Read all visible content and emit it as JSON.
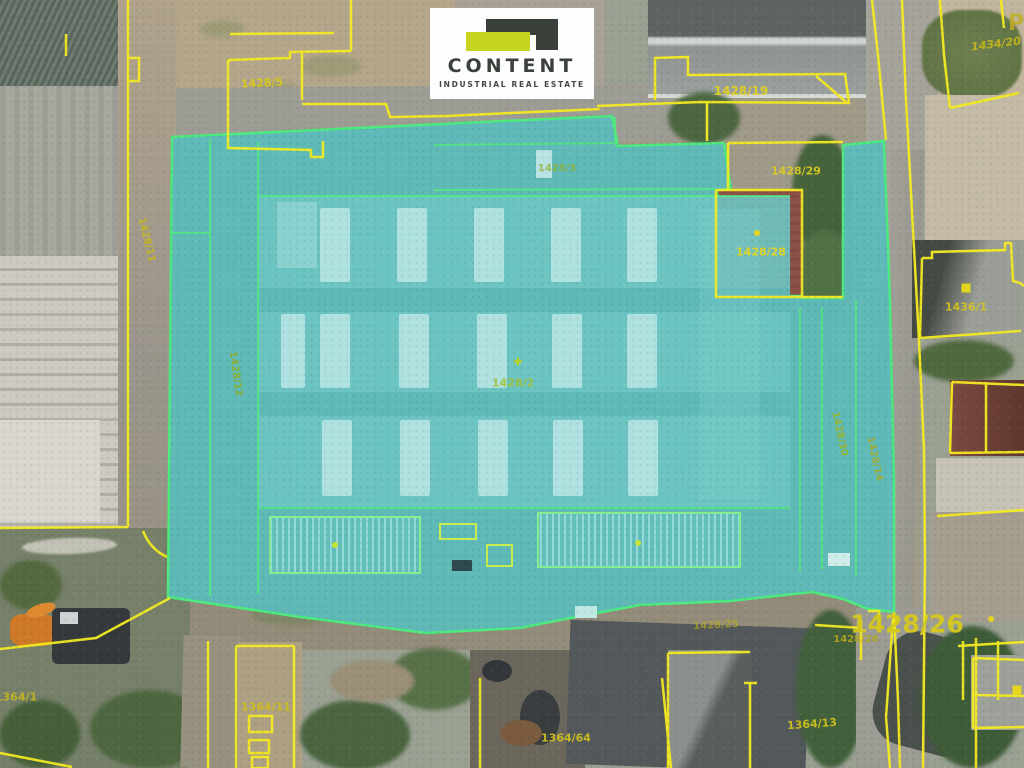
{
  "branding": {
    "logo_name": "CONTENT",
    "logo_tagline": "INDUSTRIAL REAL ESTATE",
    "logo_lime": "#c6d31f",
    "logo_charcoal": "#393f39"
  },
  "map": {
    "highlighted_parcel": "1428/2",
    "highlight_fill": "#5cbcba",
    "highlight_border": "#4dea7e",
    "parcel_line_color": "#f3ea22",
    "parcel_labels": [
      {
        "text": "1428/5",
        "x": 262,
        "y": 83,
        "size": 11,
        "rot": -3,
        "color": "#d8c81f",
        "opacity": 0.95
      },
      {
        "text": "1428/19",
        "x": 741,
        "y": 91,
        "size": 12,
        "rot": 0,
        "color": "#e0d122",
        "opacity": 0.95
      },
      {
        "text": "1428/29",
        "x": 796,
        "y": 171,
        "size": 11,
        "rot": 0,
        "color": "#ddcd20",
        "opacity": 0.9
      },
      {
        "text": "1428/28",
        "x": 761,
        "y": 252,
        "size": 11,
        "rot": 0,
        "color": "#e6d51f",
        "opacity": 0.95
      },
      {
        "text": "1434/20",
        "x": 996,
        "y": 44,
        "size": 11,
        "rot": -7,
        "color": "#c8b81a",
        "opacity": 0.9,
        "italic": true
      },
      {
        "text": "P",
        "x": 1016,
        "y": 24,
        "size": 22,
        "rot": 0,
        "color": "#c0ae23",
        "opacity": 0.85,
        "bold": true
      },
      {
        "text": "1436/1",
        "x": 966,
        "y": 307,
        "size": 11,
        "rot": 0,
        "color": "#d6c51e",
        "opacity": 0.9
      },
      {
        "text": "1428/11",
        "x": 146,
        "y": 240,
        "size": 10,
        "rot": 76,
        "color": "#c7b81c",
        "opacity": 0.9
      },
      {
        "text": "1428/12",
        "x": 235,
        "y": 374,
        "size": 10,
        "rot": 82,
        "color": "#8fae2b",
        "opacity": 0.9
      },
      {
        "text": "1428/3",
        "x": 557,
        "y": 169,
        "size": 10,
        "rot": 0,
        "color": "#93b02c",
        "opacity": 0.75
      },
      {
        "text": "1428/2",
        "x": 513,
        "y": 383,
        "size": 11,
        "rot": 0,
        "color": "#a3c02e",
        "opacity": 0.85
      },
      {
        "text": "1428/30",
        "x": 839,
        "y": 434,
        "size": 10,
        "rot": 78,
        "color": "#9cb42a",
        "opacity": 0.9
      },
      {
        "text": "1428/14",
        "x": 874,
        "y": 459,
        "size": 10,
        "rot": 78,
        "color": "#a8ab28",
        "opacity": 0.85
      },
      {
        "text": "1428/26",
        "x": 907,
        "y": 624,
        "size": 25,
        "rot": 0,
        "color": "#d6c91d",
        "opacity": 0.95,
        "bold": true
      },
      {
        "text": "1428/26",
        "x": 856,
        "y": 640,
        "size": 10,
        "rot": 0,
        "color": "#b5a81c",
        "opacity": 0.9
      },
      {
        "text": "1428/25",
        "x": 716,
        "y": 626,
        "size": 10,
        "rot": -3,
        "color": "#b7ac25",
        "opacity": 0.7
      },
      {
        "text": "1364/1",
        "x": 16,
        "y": 697,
        "size": 11,
        "rot": 0,
        "color": "#c9ba1d",
        "opacity": 0.9
      },
      {
        "text": "1364/11",
        "x": 266,
        "y": 707,
        "size": 11,
        "rot": 0,
        "color": "#cdbd1e",
        "opacity": 0.95
      },
      {
        "text": "1364/64",
        "x": 566,
        "y": 738,
        "size": 11,
        "rot": 0,
        "color": "#cfbf1e",
        "opacity": 0.95
      },
      {
        "text": "1364/13",
        "x": 812,
        "y": 724,
        "size": 11,
        "rot": -4,
        "color": "#cfc01e",
        "opacity": 0.95
      }
    ],
    "markers": [
      {
        "x": 518,
        "y": 362,
        "type": "cross",
        "color": "#b9d21f"
      },
      {
        "x": 335,
        "y": 545,
        "type": "dot",
        "color": "#c6e436"
      },
      {
        "x": 638,
        "y": 543,
        "type": "dot",
        "color": "#c6e436"
      },
      {
        "x": 757,
        "y": 233,
        "type": "dot",
        "color": "#e6d51f"
      },
      {
        "x": 966,
        "y": 288,
        "type": "square",
        "color": "#e6d51f"
      },
      {
        "x": 991,
        "y": 619,
        "type": "dot",
        "color": "#e6d51f"
      },
      {
        "x": 1017,
        "y": 690,
        "type": "square",
        "color": "#e6d51f"
      }
    ]
  }
}
